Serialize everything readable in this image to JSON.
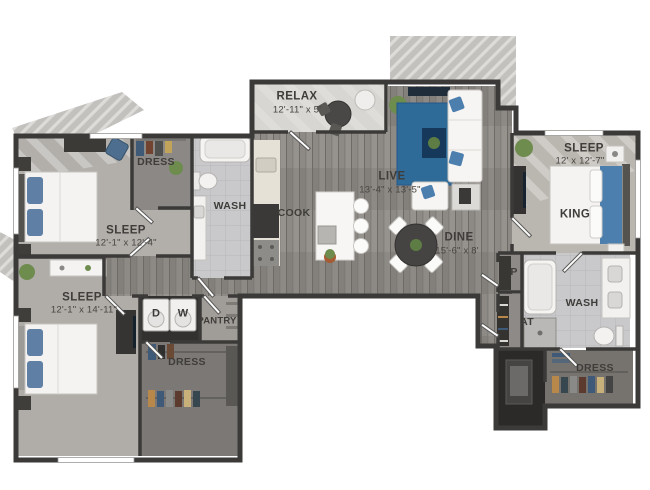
{
  "floorplan": {
    "relax": {
      "name": "RELAX",
      "dims": "12'-11\" x 5'"
    },
    "live": {
      "name": "LIVE",
      "dims": "13'-4\" x 13'-5\""
    },
    "dine": {
      "name": "DINE",
      "dims": "15'-6\" x 8'"
    },
    "cook": {
      "name": "COOK"
    },
    "sleep_upper_left": {
      "name": "SLEEP",
      "dims": "12'-1\" x 12'-4\""
    },
    "sleep_lower_left": {
      "name": "SLEEP",
      "dims": "12'-1\" x 14'-11\""
    },
    "sleep_right": {
      "name": "SLEEP",
      "dims": "12' x 12'-7\"",
      "bed": "KING"
    },
    "wash_main": {
      "name": "WASH"
    },
    "wash_ensuite": {
      "name": "WASH"
    },
    "dress_upper_left": {
      "name": "DRESS"
    },
    "dress_lower_left": {
      "name": "DRESS"
    },
    "dress_right": {
      "name": "DRESS"
    },
    "pantry": {
      "name": "PANTRY"
    },
    "laundry": {
      "dryer": "D",
      "washer": "W"
    },
    "closet_p": {
      "label": "P"
    },
    "closet_coat": {
      "label": "AT"
    }
  },
  "colors": {
    "wall": "#3b3a38",
    "wood_floor": "#8d8a86",
    "carpet": "#b2afab",
    "tile": "#c9c9cb",
    "balcony": "#d7d6d3",
    "rug_blue": "#2e6b99",
    "pillow_blue": "#4d7fae"
  }
}
